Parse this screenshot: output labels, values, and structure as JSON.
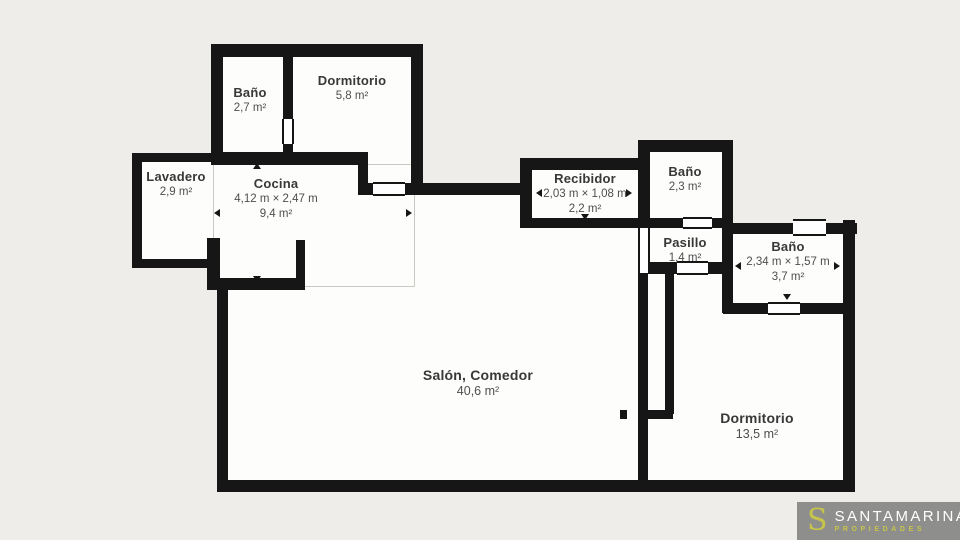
{
  "rooms": {
    "bano_tl": {
      "name": "Baño",
      "area": "2,7 m²"
    },
    "dormitorio_tl": {
      "name": "Dormitorio",
      "area": "5,8 m²"
    },
    "lavadero": {
      "name": "Lavadero",
      "area": "2,9 m²"
    },
    "cocina": {
      "name": "Cocina",
      "dimensions": "4,12 m × 2,47 m",
      "area": "9,4 m²"
    },
    "recibidor": {
      "name": "Recibidor",
      "dimensions": "2,03 m × 1,08 m",
      "area": "2,2 m²"
    },
    "bano_pasillo": {
      "name": "Baño",
      "area": "2,3 m²"
    },
    "pasillo": {
      "name": "Pasillo",
      "area": "1,4 m²"
    },
    "bano_suite": {
      "name": "Baño",
      "dimensions": "2,34 m × 1,57 m",
      "area": "3,7 m²"
    },
    "salon": {
      "name": "Salón, Comedor",
      "area": "40,6 m²"
    },
    "dormitorio_main": {
      "name": "Dormitorio",
      "area": "13,5 m²"
    }
  },
  "logo": {
    "initial": "S",
    "brand": "SANTAMARINA",
    "tagline": "PROPIEDADES"
  },
  "colors": {
    "wall": "#161616",
    "floor": "#fdfdfc",
    "background": "#efedea",
    "accent": "#c6c44a",
    "logo_bg": "#8e8e8c"
  }
}
